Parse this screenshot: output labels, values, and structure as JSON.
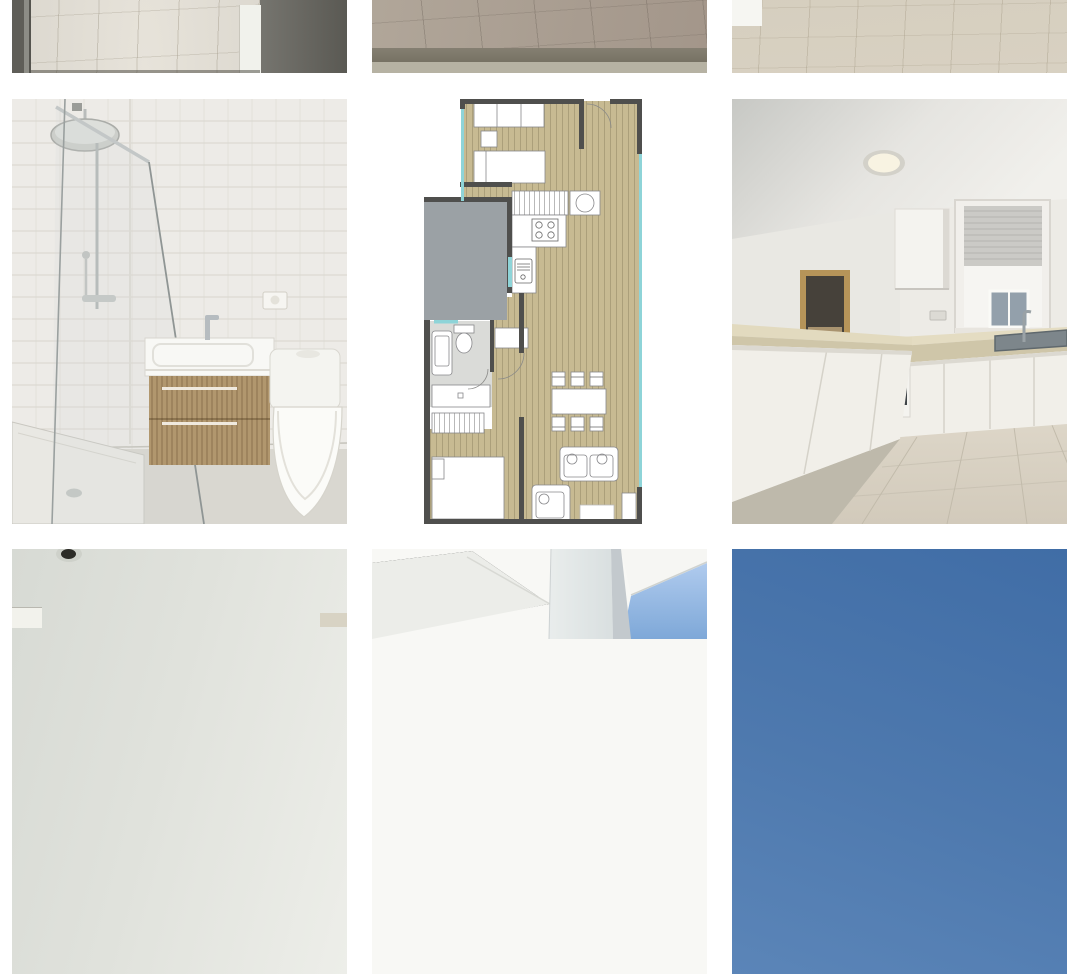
{
  "app": {
    "description": "Real-estate listing photo gallery grid, 3 columns, white background, no visible text",
    "background": "#ffffff"
  },
  "gallery": {
    "layout": {
      "columns": 3,
      "tile_width_px": 335,
      "tile_height_px": 425,
      "gap_px": 25,
      "left_margin_px": 12
    },
    "photos": [
      {
        "id": "photo-1",
        "label": "Hallway with tiled wood floor seen between dark door frames (bottom portion visible)"
      },
      {
        "id": "photo-2",
        "label": "Brown wooden floor of empty room (bottom portion visible)"
      },
      {
        "id": "photo-3",
        "label": "Light wooden floor of empty room (bottom portion visible)"
      },
      {
        "id": "photo-4",
        "label": "Bathroom with glass walk-in shower, rain shower head, wooden vanity with white basin, toilet and wall socket"
      },
      {
        "id": "photo-5",
        "label": "Apartment floor plan with bedrooms, bathroom, kitchen, dining table, sofa and terrace windows"
      },
      {
        "id": "photo-6",
        "label": "White kitchen with L-shaped counter, built-in oven, upper cabinet, window with roller blind and sink"
      },
      {
        "id": "photo-7",
        "label": "Ceiling with recessed spotlight opening (top portion visible)"
      },
      {
        "id": "photo-8",
        "label": "Terrace ceiling with white pillar and blue sky (top portion visible)"
      },
      {
        "id": "photo-9",
        "label": "Clear blue sky (top portion visible)"
      }
    ],
    "palette": {
      "plan_floor": "#c7ba92",
      "plan_wall": "#4f4f4d",
      "plan_window_glazing": "#8ed4d8",
      "plan_adjacent_block": "#9ba1a5",
      "bathroom_tile": "#edebe7",
      "vanity_wood": "#b1976e",
      "kitchen_countertop": "#d9d0b4",
      "kitchen_cabinet": "#f1efe9",
      "sky_deep": "#406da6",
      "sky_light": "#9fc0e6"
    }
  }
}
